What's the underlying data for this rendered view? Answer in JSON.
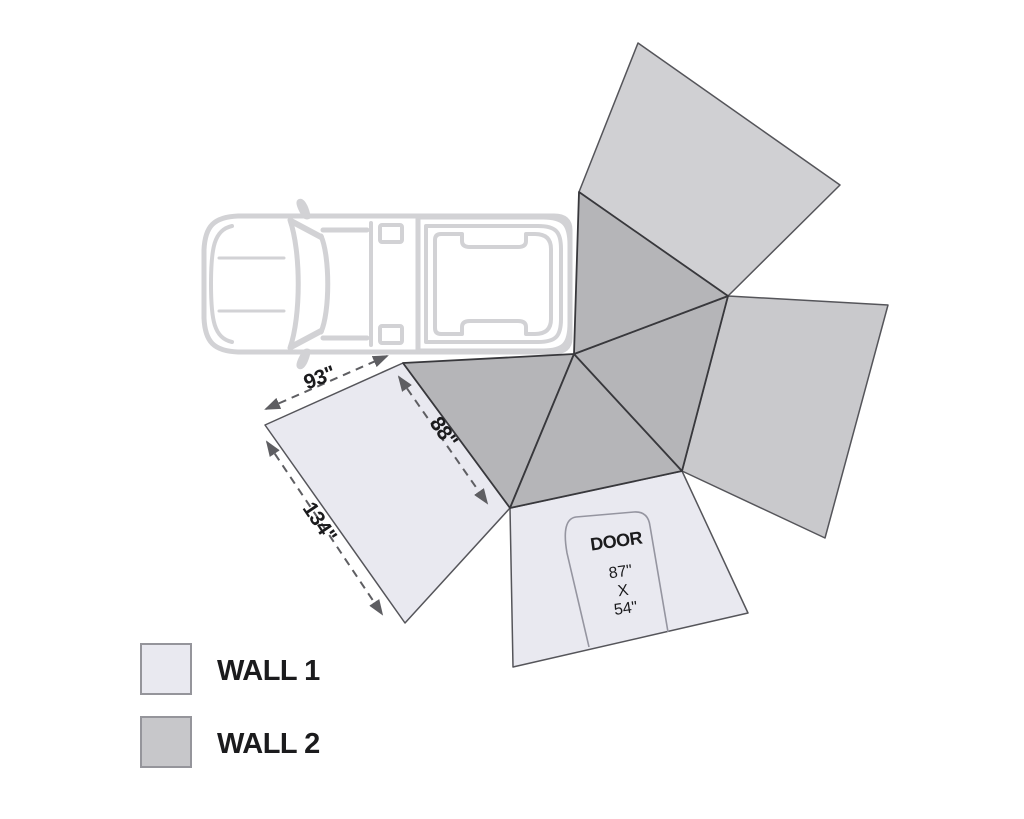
{
  "diagram": {
    "title_hidden": "",
    "icons": {
      "vehicle": "pickup-truck-top-view-icon"
    },
    "dimensions": {
      "wall1_top_edge": "93\"",
      "awning_edge": "88\"",
      "wall1_side_edge": "134\""
    },
    "door": {
      "label": "DOOR",
      "height": "87\"",
      "separator": "X",
      "width": "54\""
    },
    "legend": {
      "items": [
        {
          "label": "WALL 1",
          "color": "#e9e9f0"
        },
        {
          "label": "WALL 2",
          "color": "#c7c7ca"
        }
      ]
    },
    "colors": {
      "wall1": "#e9e9f0",
      "wall2_right": "#c9c9cc",
      "wall2_top": "#d0d0d3",
      "canopy": "#b5b5b8",
      "outline": "#55555a",
      "canopy_edge": "#38383c",
      "truck": "#d2d2d5",
      "dimension": "#5e5e62",
      "door_line": "#9595a0",
      "text": "#1b1b1d",
      "swatch_border": "#95959b",
      "background": "#ffffff"
    }
  }
}
